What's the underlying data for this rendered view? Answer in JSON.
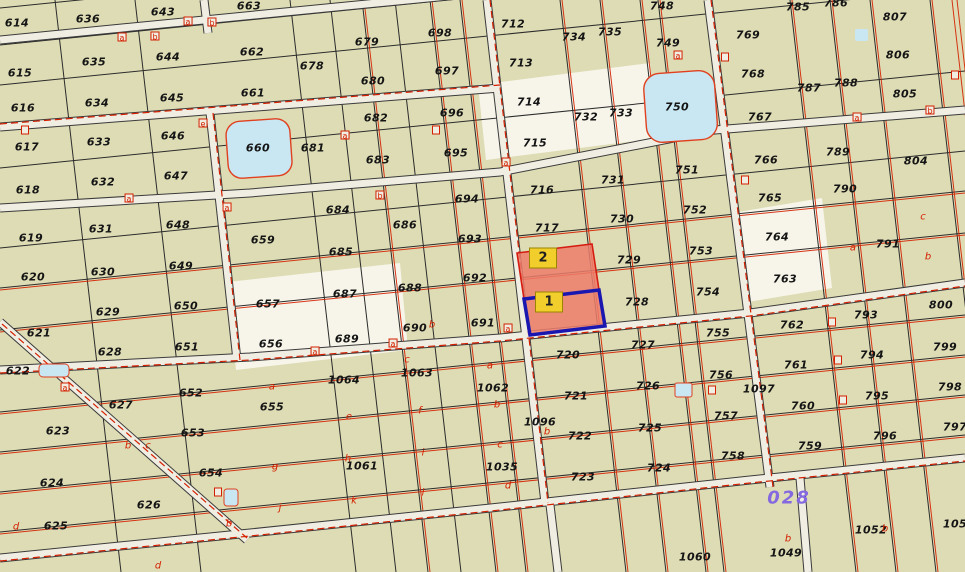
{
  "map": {
    "block_number": "028",
    "colors": {
      "background": "#DEDCB5",
      "road": "#F0EEE2",
      "cadastral_red": "#D42000",
      "lake_fill": "#C9E7F2",
      "highlight_fill": "#ED7C6B",
      "selected_border_blue": "#1A17B0",
      "highlight_label_bg": "#F2CE2C",
      "block_number_purple": "#8468E0"
    },
    "highlight": {
      "parcel_1": {
        "label": "1"
      },
      "parcel_2": {
        "label": "2"
      }
    },
    "parcels": [
      {
        "n": "614",
        "x": 17,
        "y": 23
      },
      {
        "n": "615",
        "x": 20,
        "y": 73
      },
      {
        "n": "616",
        "x": 23,
        "y": 108
      },
      {
        "n": "617",
        "x": 27,
        "y": 147
      },
      {
        "n": "618",
        "x": 28,
        "y": 190
      },
      {
        "n": "619",
        "x": 31,
        "y": 238
      },
      {
        "n": "620",
        "x": 33,
        "y": 277
      },
      {
        "n": "621",
        "x": 39,
        "y": 333
      },
      {
        "n": "622",
        "x": 18,
        "y": 371
      },
      {
        "n": "623",
        "x": 58,
        "y": 431
      },
      {
        "n": "624",
        "x": 52,
        "y": 483
      },
      {
        "n": "625",
        "x": 56,
        "y": 526
      },
      {
        "n": "626",
        "x": 149,
        "y": 505
      },
      {
        "n": "636",
        "x": 88,
        "y": 19
      },
      {
        "n": "635",
        "x": 94,
        "y": 62
      },
      {
        "n": "634",
        "x": 97,
        "y": 103
      },
      {
        "n": "633",
        "x": 99,
        "y": 142
      },
      {
        "n": "632",
        "x": 103,
        "y": 182
      },
      {
        "n": "631",
        "x": 101,
        "y": 229
      },
      {
        "n": "630",
        "x": 103,
        "y": 272
      },
      {
        "n": "629",
        "x": 108,
        "y": 312
      },
      {
        "n": "628",
        "x": 110,
        "y": 352
      },
      {
        "n": "627",
        "x": 121,
        "y": 405
      },
      {
        "n": "643",
        "x": 163,
        "y": 12
      },
      {
        "n": "644",
        "x": 168,
        "y": 57
      },
      {
        "n": "645",
        "x": 172,
        "y": 98
      },
      {
        "n": "646",
        "x": 173,
        "y": 136
      },
      {
        "n": "647",
        "x": 176,
        "y": 176
      },
      {
        "n": "648",
        "x": 178,
        "y": 225
      },
      {
        "n": "649",
        "x": 181,
        "y": 266
      },
      {
        "n": "650",
        "x": 186,
        "y": 306
      },
      {
        "n": "651",
        "x": 187,
        "y": 347
      },
      {
        "n": "652",
        "x": 191,
        "y": 393
      },
      {
        "n": "653",
        "x": 193,
        "y": 433
      },
      {
        "n": "654",
        "x": 211,
        "y": 473
      },
      {
        "n": "663",
        "x": 249,
        "y": 6
      },
      {
        "n": "662",
        "x": 252,
        "y": 52
      },
      {
        "n": "661",
        "x": 253,
        "y": 93
      },
      {
        "n": "660",
        "x": 258,
        "y": 148
      },
      {
        "n": "659",
        "x": 263,
        "y": 240
      },
      {
        "n": "657",
        "x": 268,
        "y": 304
      },
      {
        "n": "656",
        "x": 271,
        "y": 344
      },
      {
        "n": "655",
        "x": 272,
        "y": 407
      },
      {
        "n": "678",
        "x": 312,
        "y": 66
      },
      {
        "n": "679",
        "x": 367,
        "y": 42
      },
      {
        "n": "680",
        "x": 373,
        "y": 81
      },
      {
        "n": "681",
        "x": 313,
        "y": 148
      },
      {
        "n": "682",
        "x": 376,
        "y": 118
      },
      {
        "n": "683",
        "x": 378,
        "y": 160
      },
      {
        "n": "684",
        "x": 338,
        "y": 210
      },
      {
        "n": "685",
        "x": 341,
        "y": 252
      },
      {
        "n": "686",
        "x": 405,
        "y": 225
      },
      {
        "n": "687",
        "x": 345,
        "y": 294
      },
      {
        "n": "688",
        "x": 410,
        "y": 288
      },
      {
        "n": "689",
        "x": 347,
        "y": 339
      },
      {
        "n": "690",
        "x": 415,
        "y": 328
      },
      {
        "n": "691",
        "x": 483,
        "y": 323
      },
      {
        "n": "692",
        "x": 475,
        "y": 278
      },
      {
        "n": "693",
        "x": 470,
        "y": 239
      },
      {
        "n": "694",
        "x": 467,
        "y": 199
      },
      {
        "n": "695",
        "x": 456,
        "y": 153
      },
      {
        "n": "696",
        "x": 452,
        "y": 113
      },
      {
        "n": "697",
        "x": 447,
        "y": 71
      },
      {
        "n": "698",
        "x": 440,
        "y": 33
      },
      {
        "n": "1064",
        "x": 344,
        "y": 380
      },
      {
        "n": "1063",
        "x": 417,
        "y": 373
      },
      {
        "n": "1062",
        "x": 493,
        "y": 388
      },
      {
        "n": "1061",
        "x": 362,
        "y": 466
      },
      {
        "n": "1096",
        "x": 540,
        "y": 422
      },
      {
        "n": "1035",
        "x": 502,
        "y": 467
      },
      {
        "n": "712",
        "x": 513,
        "y": 24
      },
      {
        "n": "713",
        "x": 521,
        "y": 63
      },
      {
        "n": "714",
        "x": 529,
        "y": 102
      },
      {
        "n": "715",
        "x": 535,
        "y": 143
      },
      {
        "n": "716",
        "x": 542,
        "y": 190
      },
      {
        "n": "717",
        "x": 547,
        "y": 228
      },
      {
        "n": "720",
        "x": 568,
        "y": 355
      },
      {
        "n": "721",
        "x": 576,
        "y": 396
      },
      {
        "n": "722",
        "x": 580,
        "y": 436
      },
      {
        "n": "723",
        "x": 583,
        "y": 477
      },
      {
        "n": "734",
        "x": 574,
        "y": 37
      },
      {
        "n": "735",
        "x": 610,
        "y": 32
      },
      {
        "n": "732",
        "x": 586,
        "y": 117
      },
      {
        "n": "733",
        "x": 621,
        "y": 113
      },
      {
        "n": "731",
        "x": 613,
        "y": 180
      },
      {
        "n": "730",
        "x": 622,
        "y": 219
      },
      {
        "n": "729",
        "x": 629,
        "y": 260
      },
      {
        "n": "728",
        "x": 637,
        "y": 302
      },
      {
        "n": "727",
        "x": 643,
        "y": 345
      },
      {
        "n": "726",
        "x": 648,
        "y": 386
      },
      {
        "n": "725",
        "x": 650,
        "y": 428
      },
      {
        "n": "724",
        "x": 659,
        "y": 468
      },
      {
        "n": "748",
        "x": 662,
        "y": 6
      },
      {
        "n": "749",
        "x": 668,
        "y": 43
      },
      {
        "n": "750",
        "x": 677,
        "y": 107
      },
      {
        "n": "751",
        "x": 687,
        "y": 170
      },
      {
        "n": "752",
        "x": 695,
        "y": 210
      },
      {
        "n": "753",
        "x": 701,
        "y": 251
      },
      {
        "n": "754",
        "x": 708,
        "y": 292
      },
      {
        "n": "755",
        "x": 718,
        "y": 333
      },
      {
        "n": "756",
        "x": 721,
        "y": 375
      },
      {
        "n": "757",
        "x": 726,
        "y": 416
      },
      {
        "n": "758",
        "x": 733,
        "y": 456
      },
      {
        "n": "769",
        "x": 748,
        "y": 35
      },
      {
        "n": "768",
        "x": 753,
        "y": 74
      },
      {
        "n": "767",
        "x": 760,
        "y": 117
      },
      {
        "n": "766",
        "x": 766,
        "y": 160
      },
      {
        "n": "765",
        "x": 770,
        "y": 198
      },
      {
        "n": "764",
        "x": 777,
        "y": 237
      },
      {
        "n": "763",
        "x": 785,
        "y": 279
      },
      {
        "n": "762",
        "x": 792,
        "y": 325
      },
      {
        "n": "761",
        "x": 796,
        "y": 365
      },
      {
        "n": "760",
        "x": 803,
        "y": 406
      },
      {
        "n": "759",
        "x": 810,
        "y": 446
      },
      {
        "n": "1097",
        "x": 759,
        "y": 389
      },
      {
        "n": "785",
        "x": 798,
        "y": 7
      },
      {
        "n": "786",
        "x": 836,
        "y": 3
      },
      {
        "n": "787",
        "x": 809,
        "y": 88
      },
      {
        "n": "788",
        "x": 846,
        "y": 83
      },
      {
        "n": "789",
        "x": 838,
        "y": 152
      },
      {
        "n": "790",
        "x": 845,
        "y": 189
      },
      {
        "n": "791",
        "x": 888,
        "y": 244
      },
      {
        "n": "793",
        "x": 866,
        "y": 315
      },
      {
        "n": "794",
        "x": 872,
        "y": 355
      },
      {
        "n": "795",
        "x": 877,
        "y": 396
      },
      {
        "n": "796",
        "x": 885,
        "y": 436
      },
      {
        "n": "807",
        "x": 895,
        "y": 17
      },
      {
        "n": "806",
        "x": 898,
        "y": 55
      },
      {
        "n": "805",
        "x": 905,
        "y": 94
      },
      {
        "n": "804",
        "x": 916,
        "y": 161
      },
      {
        "n": "800",
        "x": 941,
        "y": 305
      },
      {
        "n": "799",
        "x": 945,
        "y": 347
      },
      {
        "n": "798",
        "x": 950,
        "y": 387
      },
      {
        "n": "797",
        "x": 955,
        "y": 427
      },
      {
        "n": "1060",
        "x": 695,
        "y": 557
      },
      {
        "n": "1049",
        "x": 786,
        "y": 553
      },
      {
        "n": "1052",
        "x": 871,
        "y": 530
      },
      {
        "n": "105",
        "x": 955,
        "y": 524
      }
    ],
    "sub_letters": [
      {
        "t": "a",
        "x": 272,
        "y": 387
      },
      {
        "t": "e",
        "x": 349,
        "y": 417
      },
      {
        "t": "f",
        "x": 420,
        "y": 411
      },
      {
        "t": "g",
        "x": 275,
        "y": 467
      },
      {
        "t": "h",
        "x": 348,
        "y": 459
      },
      {
        "t": "i",
        "x": 423,
        "y": 453
      },
      {
        "t": "j",
        "x": 280,
        "y": 508
      },
      {
        "t": "k",
        "x": 354,
        "y": 501
      },
      {
        "t": "l",
        "x": 423,
        "y": 493
      },
      {
        "t": "a",
        "x": 490,
        "y": 366
      },
      {
        "t": "b",
        "x": 497,
        "y": 405
      },
      {
        "t": "c",
        "x": 500,
        "y": 445
      },
      {
        "t": "d",
        "x": 508,
        "y": 486
      },
      {
        "t": "a",
        "x": 853,
        "y": 248
      },
      {
        "t": "c",
        "x": 923,
        "y": 217
      },
      {
        "t": "b",
        "x": 928,
        "y": 257
      },
      {
        "t": "b",
        "x": 788,
        "y": 539
      },
      {
        "t": "b",
        "x": 885,
        "y": 529
      },
      {
        "t": "c",
        "x": 148,
        "y": 446
      },
      {
        "t": "b",
        "x": 128,
        "y": 446
      },
      {
        "t": "b",
        "x": 229,
        "y": 524
      },
      {
        "t": "d",
        "x": 158,
        "y": 566
      },
      {
        "t": "d",
        "x": 16,
        "y": 527
      },
      {
        "t": "b",
        "x": 432,
        "y": 325
      },
      {
        "t": "c",
        "x": 407,
        "y": 360
      },
      {
        "t": "b",
        "x": 547,
        "y": 432
      }
    ],
    "markers": [
      {
        "t": "a",
        "x": 122,
        "y": 37
      },
      {
        "t": "b",
        "x": 155,
        "y": 36
      },
      {
        "t": "a",
        "x": 188,
        "y": 21
      },
      {
        "t": "b",
        "x": 212,
        "y": 22
      },
      {
        "t": "e",
        "x": 203,
        "y": 123
      },
      {
        "t": "",
        "x": 25,
        "y": 130
      },
      {
        "t": "a",
        "x": 129,
        "y": 198
      },
      {
        "t": "a",
        "x": 227,
        "y": 207
      },
      {
        "t": "a",
        "x": 65,
        "y": 387
      },
      {
        "t": "a",
        "x": 315,
        "y": 351
      },
      {
        "t": "a",
        "x": 393,
        "y": 343
      },
      {
        "t": "",
        "x": 436,
        "y": 130
      },
      {
        "t": "a",
        "x": 506,
        "y": 162
      },
      {
        "t": "a",
        "x": 508,
        "y": 328
      },
      {
        "t": "a",
        "x": 678,
        "y": 55
      },
      {
        "t": "",
        "x": 725,
        "y": 57
      },
      {
        "t": "a",
        "x": 857,
        "y": 117
      },
      {
        "t": "b",
        "x": 930,
        "y": 110
      },
      {
        "t": "",
        "x": 832,
        "y": 322
      },
      {
        "t": "",
        "x": 838,
        "y": 360
      },
      {
        "t": "",
        "x": 843,
        "y": 400
      },
      {
        "t": "",
        "x": 218,
        "y": 492
      },
      {
        "t": "",
        "x": 955,
        "y": 75
      },
      {
        "t": "",
        "x": 712,
        "y": 390
      },
      {
        "t": "",
        "x": 745,
        "y": 180
      },
      {
        "t": "a",
        "x": 345,
        "y": 135
      },
      {
        "t": "b",
        "x": 380,
        "y": 195
      }
    ]
  }
}
